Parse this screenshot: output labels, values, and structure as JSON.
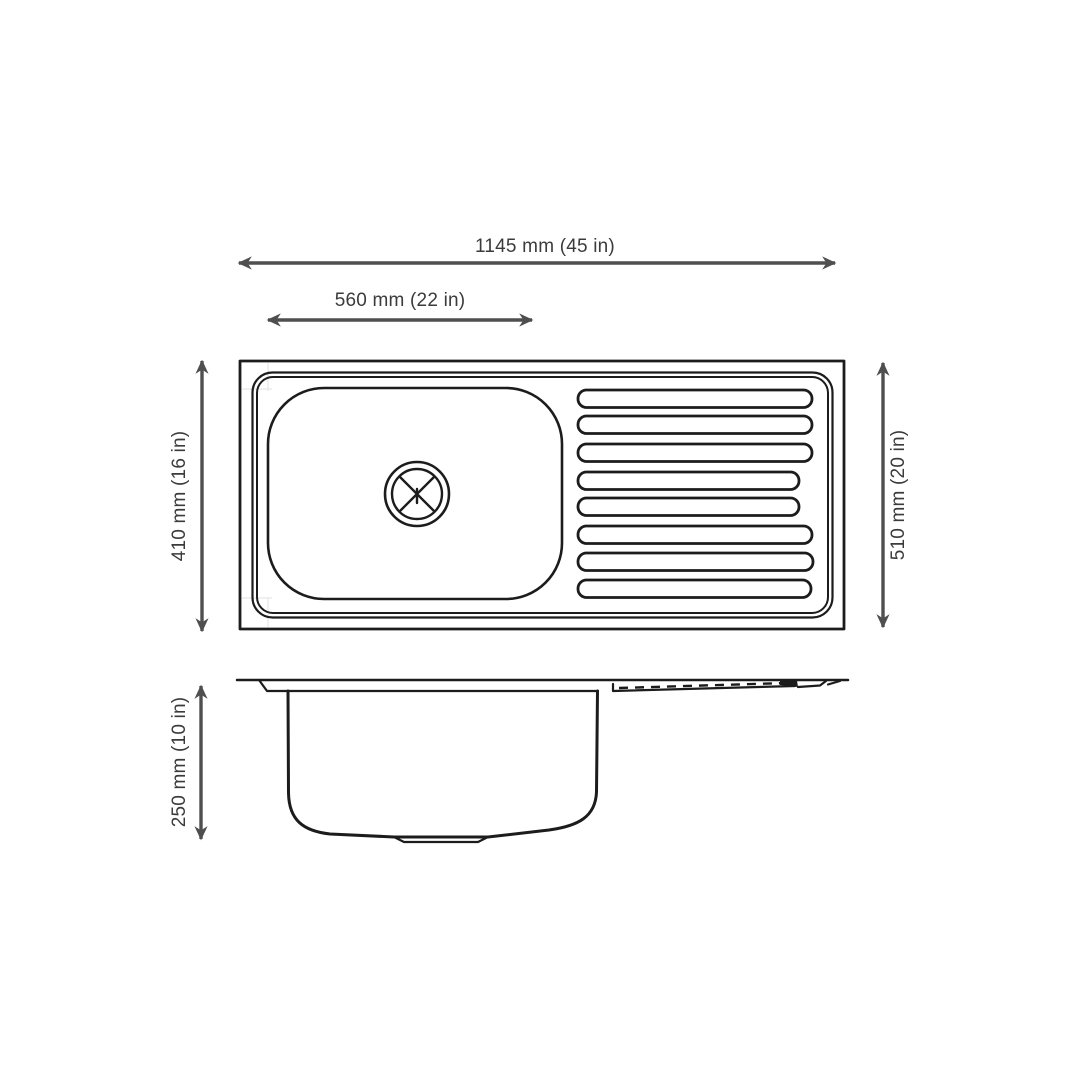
{
  "diagram": {
    "dimensions": {
      "overall_width": "1145 mm (45 in)",
      "bowl_width": "560 mm (22 in)",
      "left_height": "410 mm (16 in)",
      "right_height": "510 mm (20 in)",
      "bowl_depth": "250 mm (10 in)"
    },
    "colors": {
      "line": "#1c1c1c",
      "dimension": "#4f4f4f",
      "text": "#3b3b3b",
      "background": "#ffffff"
    }
  }
}
